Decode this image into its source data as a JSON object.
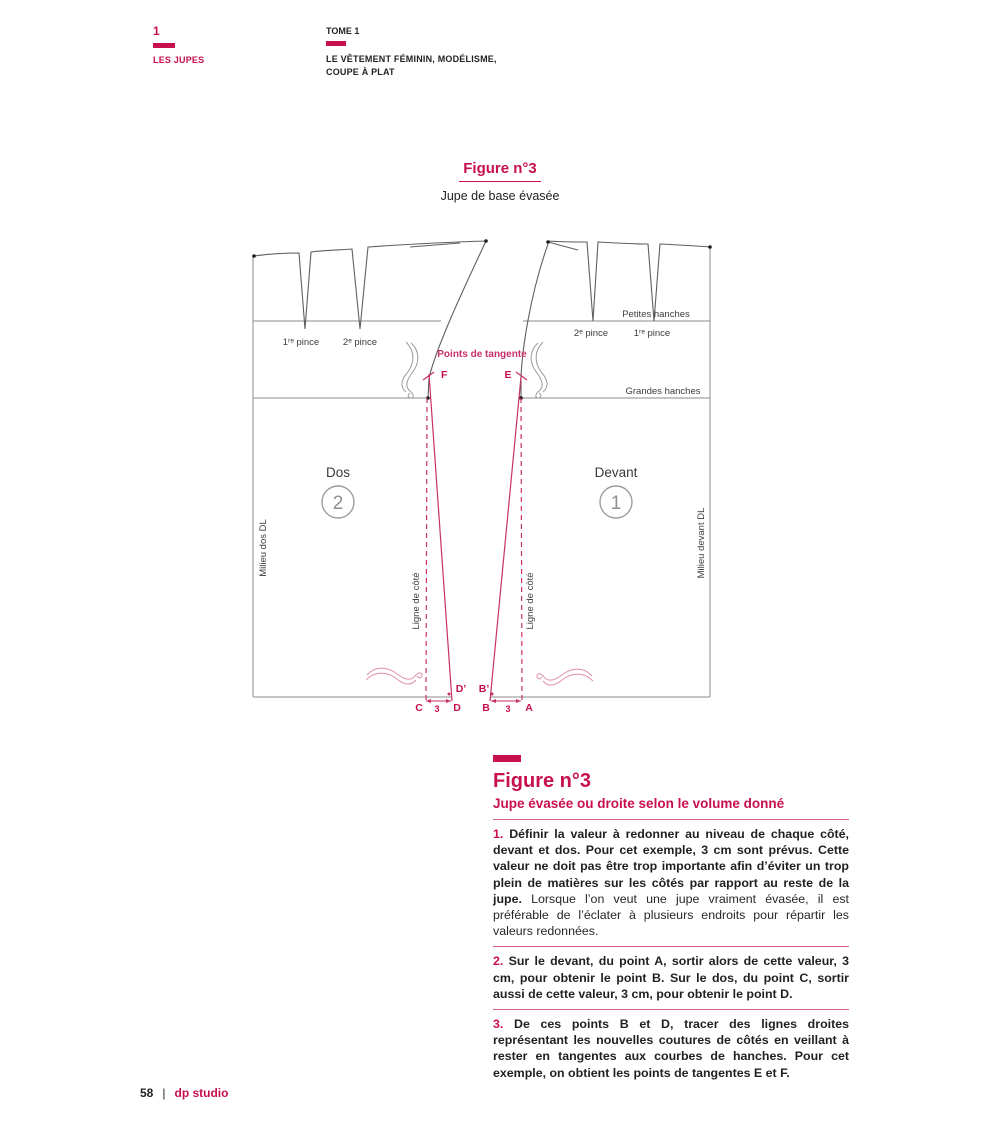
{
  "colors": {
    "accent": "#c8104e",
    "dark_text": "#231f20",
    "grey_line": "#8b8b8b",
    "curve_line": "#5f5f5f",
    "ruler_pink": "#dd8fac"
  },
  "header": {
    "chapter_number": "1",
    "chapter_title": "LES JUPES",
    "tome": "TOME 1",
    "book_title_line1": "LE VÊTEMENT FÉMININ,  MODÉLISME,",
    "book_title_line2": "COUPE À PLAT"
  },
  "figure_caption": {
    "title": "Figure n°3",
    "subtitle": "Jupe de base évasée"
  },
  "diagram": {
    "points_de_tangente": "Points de tangente",
    "dos_title": "Dos",
    "dos_number": "2",
    "devant_title": "Devant",
    "devant_number": "1",
    "dos_dart1": "1ʳᵉ pince",
    "dos_dart2": "2ᵉ pince",
    "devant_dart1": "1ʳᵉ pince",
    "devant_dart2": "2ᵉ pince",
    "petites_hanches": "Petites  hanches",
    "grandes_hanches": "Grandes hanches",
    "milieu_dos": "Milieu dos DL",
    "milieu_devant": "Milieu devant DL",
    "ligne_cote_dos": "Ligne de côté",
    "ligne_cote_devant": "Ligne de côté",
    "pt_F": "F",
    "pt_E": "E",
    "pt_C": "C",
    "pt_D": "D",
    "pt_D_prime": "D’",
    "pt_B": "B",
    "pt_B_prime": "B’",
    "pt_A": "A",
    "measure_dos": "3",
    "measure_devant": "3"
  },
  "text_block": {
    "title": "Figure n°3",
    "subtitle": "Jupe évasée ou droite selon le volume donné",
    "paragraphs": [
      {
        "num": "1.",
        "bold": " Définir la valeur à redonner au niveau de chaque côté, devant et dos. Pour cet exemple, 3 cm sont prévus. Cette valeur ne doit pas être trop importante afin d’éviter un trop plein de matières sur les côtés par rapport au reste de la jupe. ",
        "regular": "Lorsque l’on veut une jupe vraiment évasée, il est préférable de l’éclater à plusieurs endroits pour répartir les valeurs redonnées."
      },
      {
        "num": "2.",
        "bold": " Sur le devant, du point A, sortir alors de cette valeur, 3 cm, pour obtenir le point B. Sur le dos, du point C, sortir aussi de cette valeur, 3 cm, pour obtenir le point D.",
        "regular": ""
      },
      {
        "num": "3.",
        "bold": " De ces points B et D, tracer des lignes droites représentant les nouvelles coutures de côtés en veillant à rester en tangentes aux courbes de hanches. Pour cet exemple, on obtient les points de tangentes E et F.",
        "regular": ""
      }
    ]
  },
  "footer": {
    "page_number": "58",
    "separator": "|",
    "brand": "dp studio"
  }
}
